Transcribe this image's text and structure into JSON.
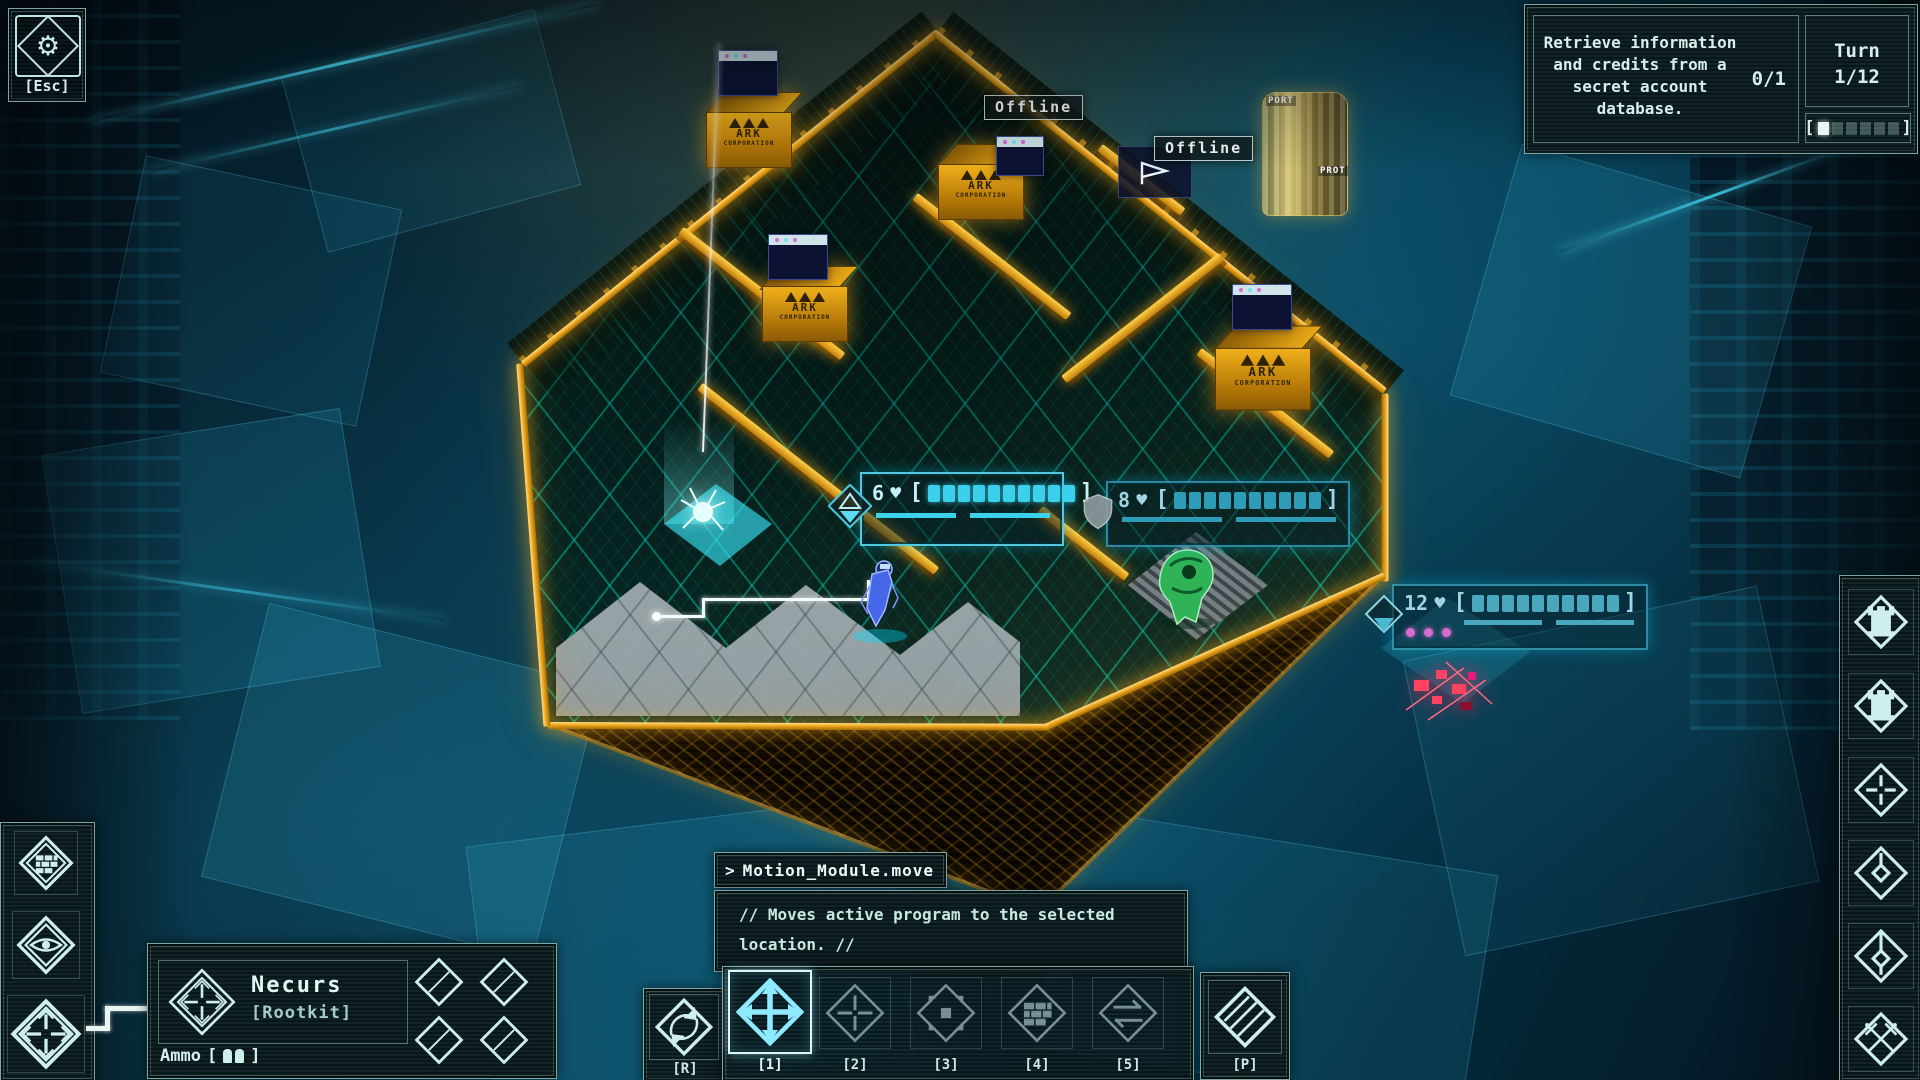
{
  "ui": {
    "bracket_open": "[",
    "bracket_close": "]"
  },
  "hud": {
    "esc_label": "[Esc]",
    "objective": {
      "lines": [
        "Retrieve information",
        "and credits from a",
        "secret account",
        "database."
      ],
      "counter": "0/1"
    },
    "turn": {
      "label": "Turn",
      "value": "1/12",
      "segments": 6,
      "filled": 1
    }
  },
  "scene": {
    "offline_labels": [
      "Offline",
      "Offline"
    ],
    "ark": {
      "name": "ARK",
      "sub": "CORPORATION"
    },
    "port_labels": [
      "PORT",
      "PROT"
    ],
    "health_bars": [
      {
        "value": "6",
        "suit": "♥",
        "blocks": 10,
        "filled": 10,
        "badge": "triangles"
      },
      {
        "value": "8",
        "suit": "♥",
        "blocks": 10,
        "filled": 10,
        "badge": "shield"
      },
      {
        "value": "12",
        "suit": "♥",
        "blocks": 10,
        "filled": 10,
        "badge": "diamond"
      }
    ]
  },
  "console": {
    "prompt": ">",
    "command": "Motion_Module.move",
    "description_lines": [
      "// Moves active program to the selected",
      "location. //"
    ]
  },
  "program": {
    "name": "Necurs",
    "type": "[Rootkit]",
    "ammo_label": "Ammo",
    "ammo_count": 2
  },
  "ability_bar": {
    "keys": [
      "[R]",
      "[1]",
      "[2]",
      "[3]",
      "[4]",
      "[5]",
      "[P]"
    ]
  },
  "right_panel": {
    "icons": [
      "tower",
      "tower",
      "target-diamond",
      "node-key",
      "node-key-long",
      "crossed-swords"
    ]
  },
  "left_panel": {
    "icons": [
      "firewall",
      "eye",
      "crosshair"
    ]
  }
}
